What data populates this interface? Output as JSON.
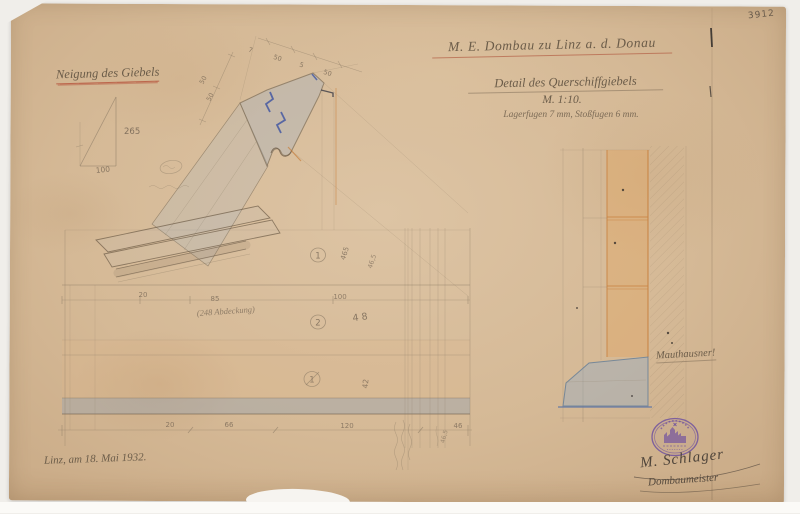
{
  "colors": {
    "scan_bg": "#f0eeea",
    "paper": "#d5b996",
    "paper_light": "#ddc4a4",
    "paper_dark": "#c8a985",
    "pencil": "#8a7a64",
    "pencil_dark": "#6e5d49",
    "graphite": "#6b5c49",
    "blue_wash": "#a0b4c6",
    "joint_blue": "#4458a2",
    "wedge_blue": "#98acc0",
    "orange": "#d9a05c",
    "orange_line": "#c98342",
    "red_line": "#b65a46",
    "stamp_purple": "#6b4da0"
  },
  "meta": {
    "archive_no": "3912"
  },
  "title_block": {
    "line1": "M. E. Dombau zu Linz a. d. Donau",
    "line2": "Detail des Querschiffgiebels",
    "scale": "M. 1:10.",
    "joints": "Lagerfugen 7 mm, Stoßfugen 6 mm."
  },
  "slope_diagram": {
    "heading": "Neigung des Giebels",
    "rise": "265",
    "run": "100"
  },
  "dims": {
    "slope": [
      "7",
      "50",
      "5",
      "50"
    ],
    "side": [
      "50",
      "50"
    ],
    "mid": [
      "20",
      "85",
      "100"
    ],
    "bottom": [
      "20",
      "66",
      "120",
      "46"
    ],
    "rot_a": "465",
    "rot_b": "46,5",
    "rot_c": "46,5",
    "d48": "48",
    "d42": "42"
  },
  "courses": {
    "c1": "1",
    "c2": "2",
    "c3": "1"
  },
  "notes": {
    "abdeckung": "(248 Abdeckung)",
    "material": "Mauthausner!"
  },
  "footer": {
    "date": "Linz, am 18. Mai 1932.",
    "signature": "M. Schlager",
    "signature_title": "Dombaumeister"
  }
}
